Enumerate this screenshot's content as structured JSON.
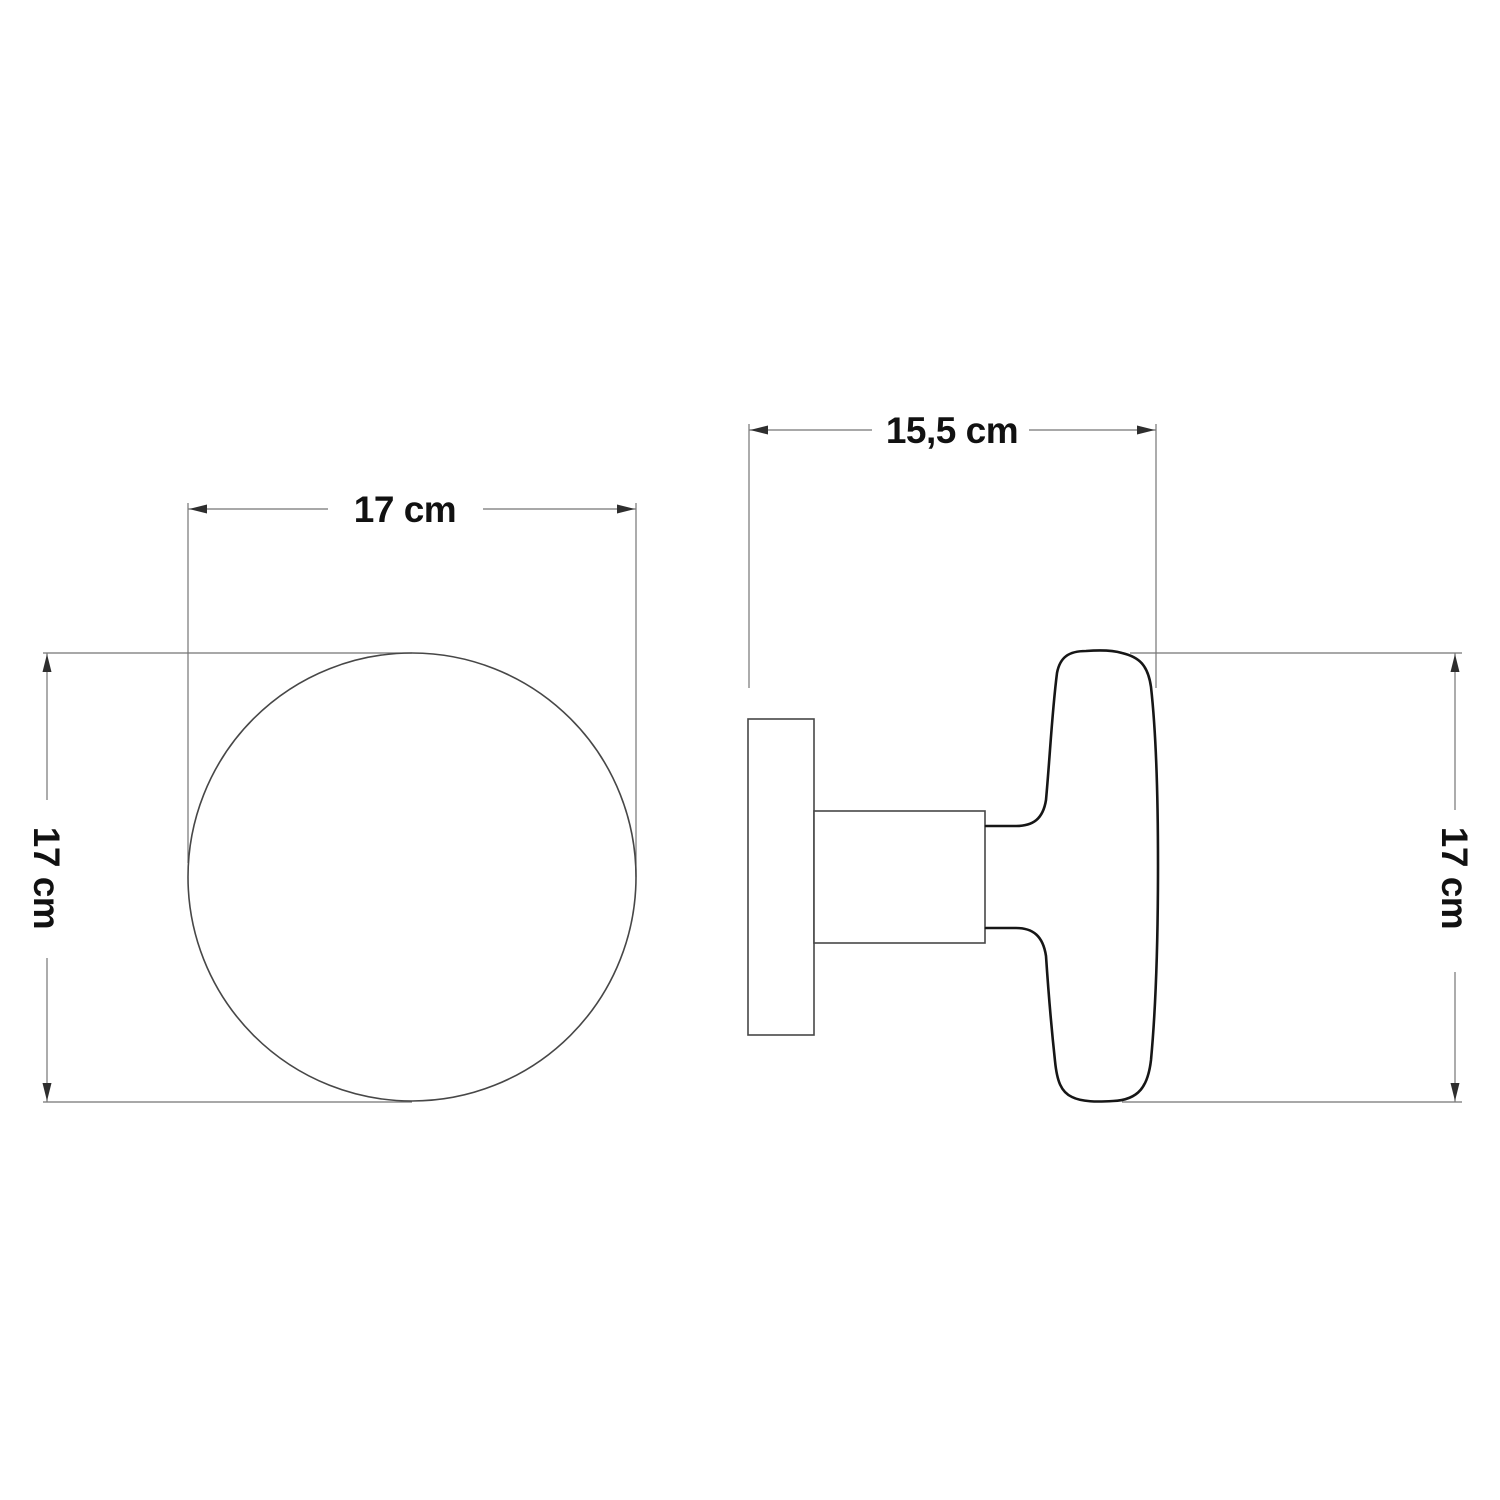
{
  "unit": "cm",
  "views": {
    "front": {
      "width_label": "17 cm",
      "height_label": "17 cm"
    },
    "side": {
      "width_label": "15,5 cm",
      "height_label": "17 cm"
    }
  },
  "colors": {
    "background": "#ffffff",
    "dimension_lines": "#757575",
    "arrowheads": "#2e2e2e",
    "object_outline_thin": "#474747",
    "object_outline_thick": "#161616",
    "label_text": "#111111"
  }
}
